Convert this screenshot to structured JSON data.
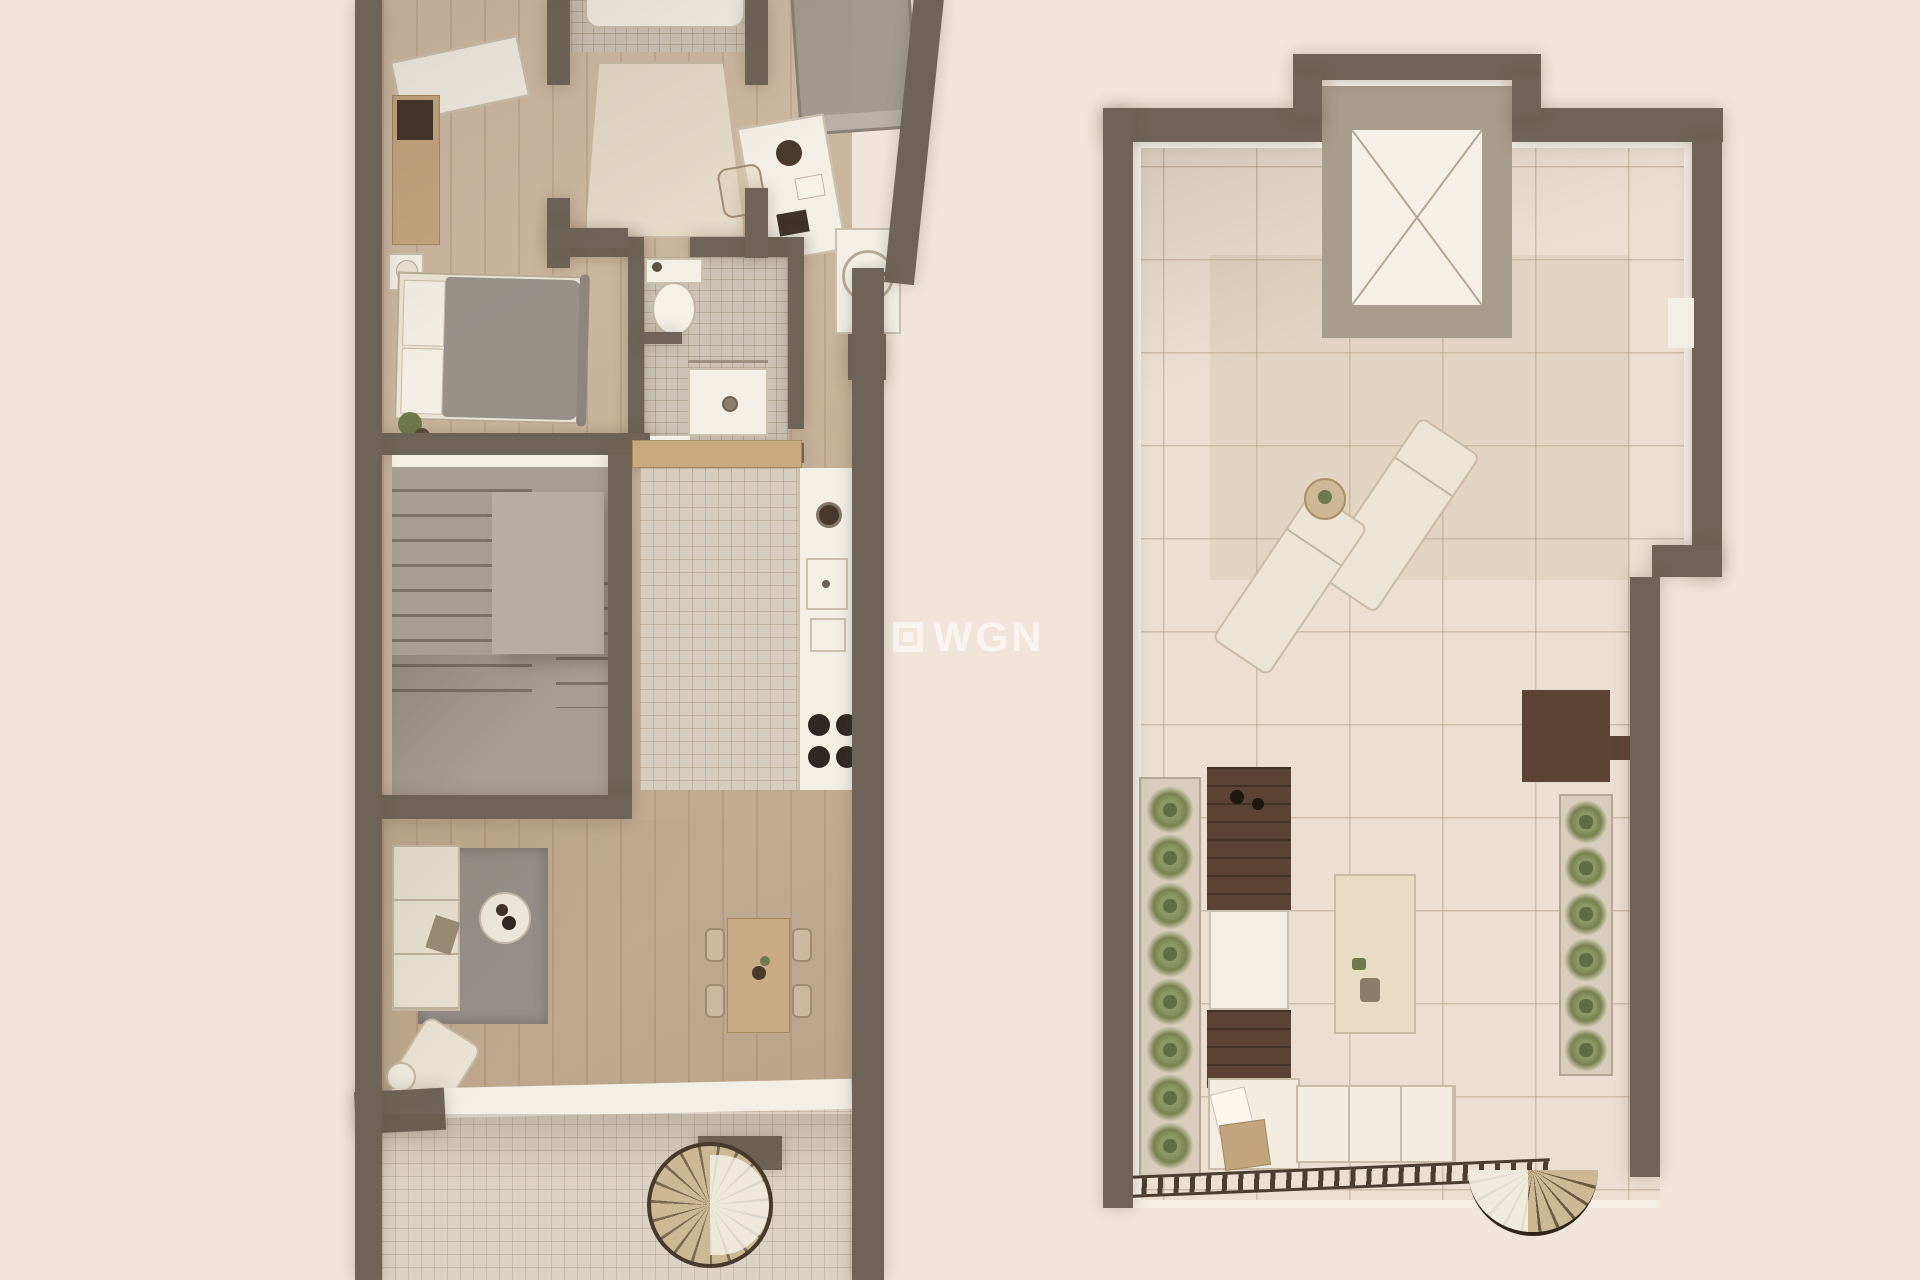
{
  "watermark": {
    "text": "WGN",
    "icon": "square-logo"
  },
  "palette": {
    "bg": "#f1e5da",
    "wall": "#6e6356",
    "white": "#f4efe5",
    "wood": "#c6ae93",
    "tileK": "#d7cdbf",
    "tileB": "#ccc3b6",
    "tileT": "#dcd2c4",
    "tileR": "#ecdfd2",
    "stair": "#a89f93",
    "landing": "#b7ada1",
    "rug": "#97908a",
    "rugHall": "#e5d9c8",
    "cream": "#ece4d4",
    "creamLine": "#c9bba6",
    "tan": "#c4a67f",
    "gray": "#98918a",
    "darkWood": "#5a4334",
    "plant": "#83905f",
    "burner": "#2f2722",
    "wm": "#ffffff"
  }
}
